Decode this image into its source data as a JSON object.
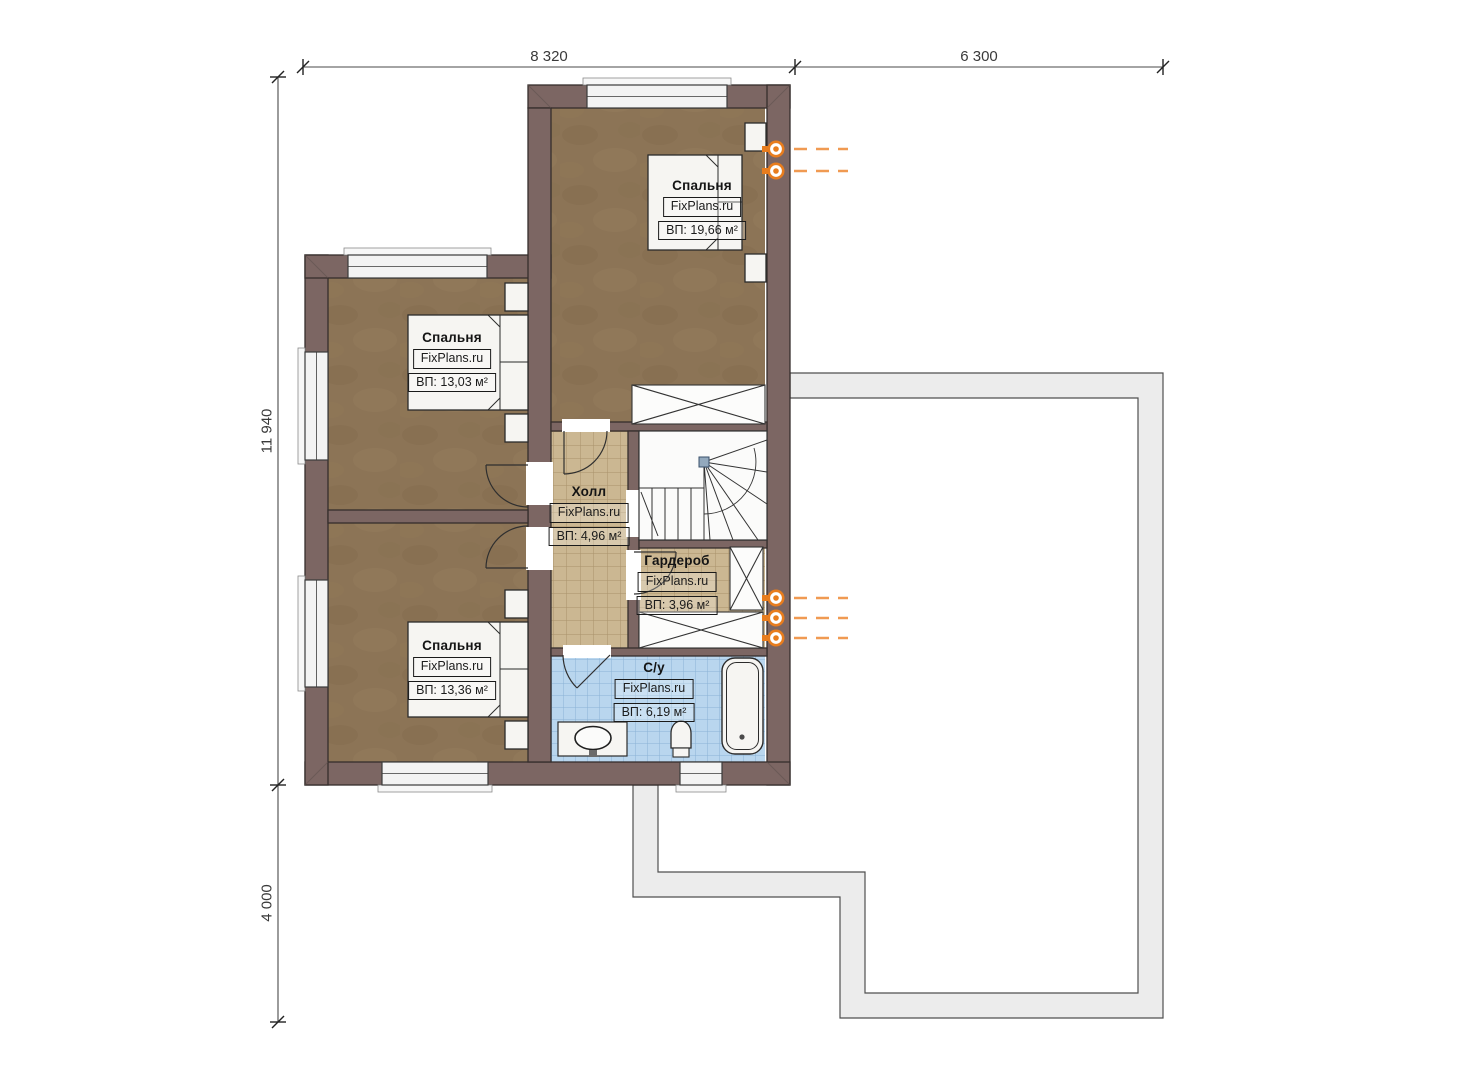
{
  "dimensions": {
    "top_main": "8 320",
    "top_right": "6 300",
    "left_main": "11 940",
    "left_bottom": "4 000"
  },
  "rooms": {
    "bedroom_top": {
      "name": "Спальня",
      "brand": "FixPlans.ru",
      "area": "ВП: 19,66 м²"
    },
    "bedroom_upper_left": {
      "name": "Спальня",
      "brand": "FixPlans.ru",
      "area": "ВП: 13,03 м²"
    },
    "bedroom_lower_left": {
      "name": "Спальня",
      "brand": "FixPlans.ru",
      "area": "ВП: 13,36 м²"
    },
    "hall": {
      "name": "Холл",
      "brand": "FixPlans.ru",
      "area": "ВП: 4,96 м²"
    },
    "wardrobe": {
      "name": "Гардероб",
      "brand": "FixPlans.ru",
      "area": "ВП: 3,96 м²"
    },
    "bathroom": {
      "name": "С/у",
      "brand": "FixPlans.ru",
      "area": "ВП: 6,19 м²"
    }
  },
  "colors": {
    "wall": "#7c6663",
    "bedroom_floor": "#8c7456",
    "tile_beige": "#cbb792",
    "tile_blue": "#b9d6ee",
    "roof_outline_fill": "#ececec",
    "accent_orange": "#e87d1e"
  }
}
